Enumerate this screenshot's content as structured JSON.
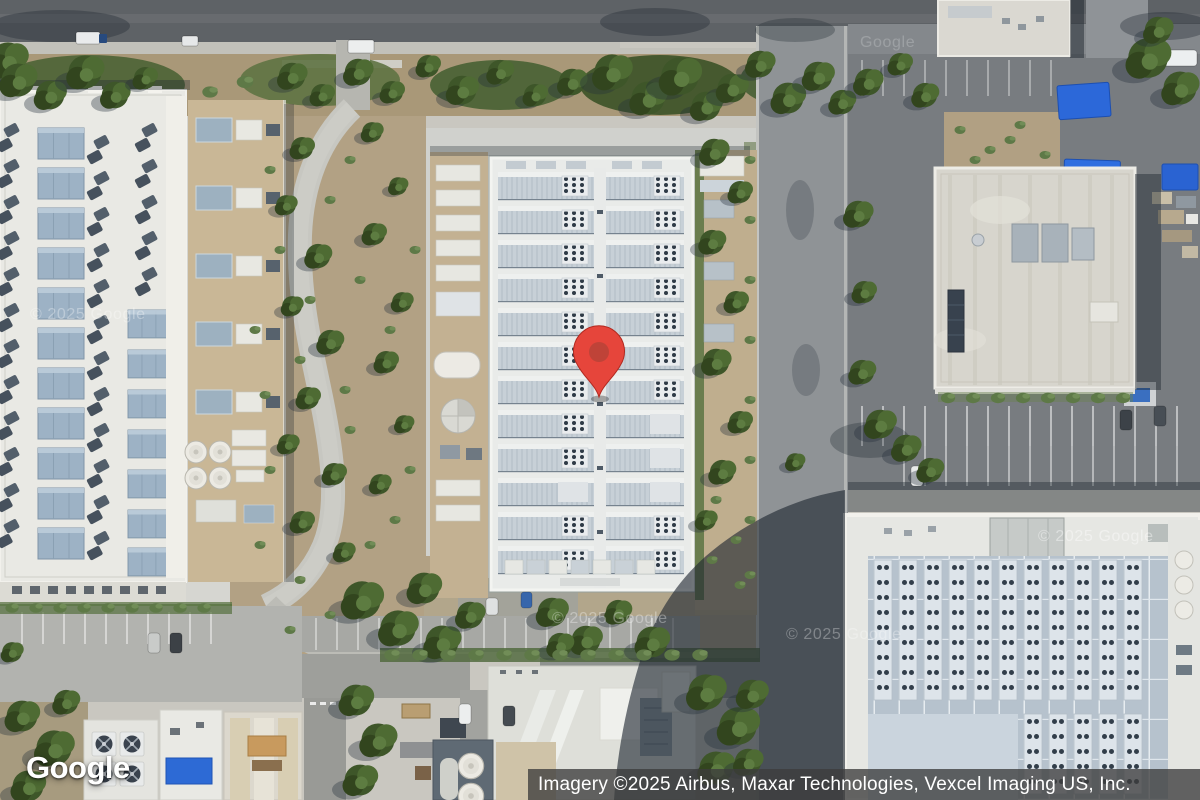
{
  "page": {
    "type": "map-satellite-view",
    "width_px": 1200,
    "height_px": 800
  },
  "map": {
    "view_mode": "satellite",
    "marker": {
      "name": "map-pin",
      "shape": "google-maps-pin",
      "fill": "#E6453B",
      "dot": "#BF4338",
      "outline": "#B2291F",
      "position_px": {
        "x": 599,
        "y": 397
      }
    },
    "logo": {
      "text": "Google",
      "color": "#FFFFFF"
    },
    "attribution": {
      "text": "Imagery ©2025 Airbus, Maxar Technologies, Vexcel Imaging US, Inc.",
      "background": "rgba(60,60,60,0.78)",
      "color": "#FFFFFF"
    },
    "watermarks": [
      {
        "text": "© 2025 Google"
      },
      {
        "text": "Google"
      },
      {
        "text": "© 2025 Google"
      },
      {
        "text": "© 2025 Google"
      },
      {
        "text": "© 2025 Google"
      }
    ],
    "scene": {
      "description": "Aerial imagery of an industrial campus: large ribbed-roof building at center marked with red pin, white flat-roof buildings with rooftop HVAC left and right, parking lots, roads, trees and a large shadowed building lower right."
    }
  }
}
